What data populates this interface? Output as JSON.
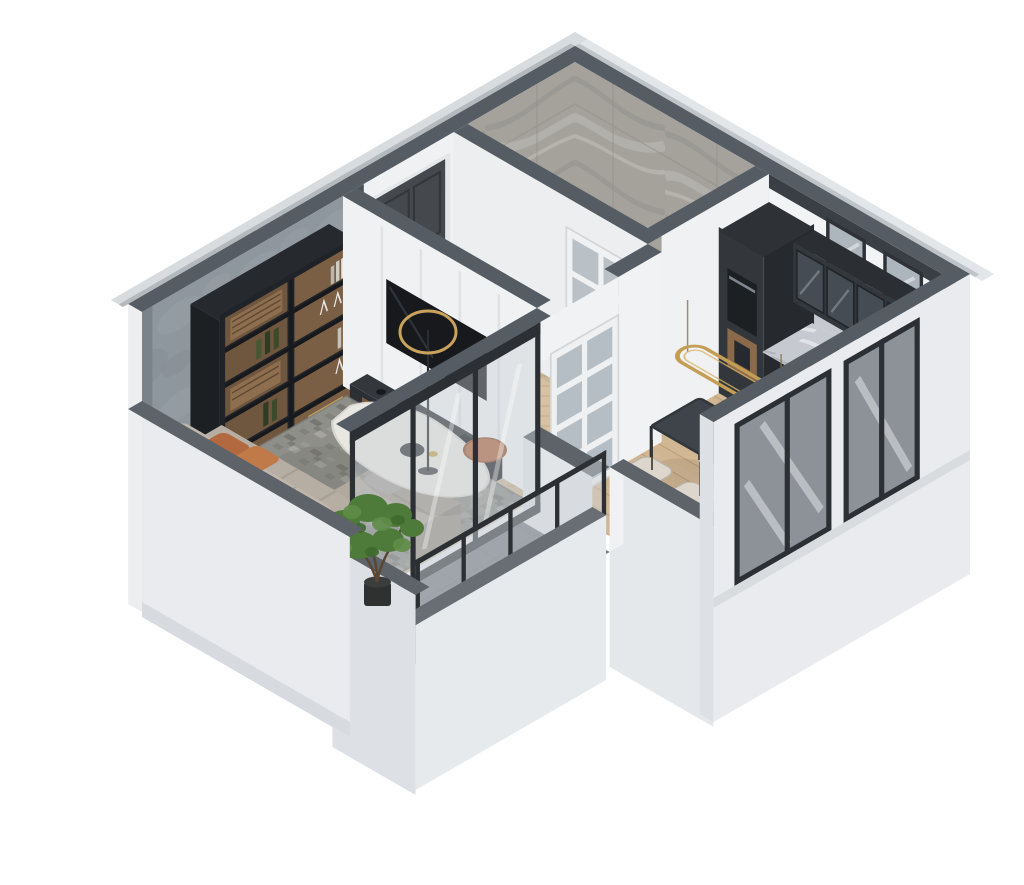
{
  "scene": {
    "title": "Isometric 3D cutaway floor plan render of a one-bedroom apartment",
    "background": "#ffffff",
    "style": "photoreal 3D render, top-down isometric cutaway, south walls lowered"
  },
  "colors": {
    "wall_top": "#565c63",
    "wall_top_low": "#5d6369",
    "ext_wall": "#e9ebee",
    "ext_wall_shade": "#d7dade",
    "int_wall": "#f2f3f4",
    "int_wall_shade": "#e6e8ea",
    "concrete": "#8f979e",
    "marble_wall": "#a5a29c",
    "charcoal": "#33373c",
    "charcoal_dark": "#26292d",
    "wood": "#7c5e41",
    "wood_light": "#8a6a4a",
    "herringbone_floor": "#d6c1a3",
    "plank_floor": "#d2b795",
    "bath_tile": "#d7cfc1",
    "rug": "#8f8f8a",
    "sofa": "#b7aea3",
    "sofa_back": "#c0b7ac",
    "cream_chair": "#dcd6cc",
    "rust": "#b2693f",
    "gold": "#c59e55",
    "glass": "#c9d0d6",
    "frame_dark": "#2c3035",
    "balcony_floor": "#71777c",
    "plant_green": "#4e7a3a",
    "table_top": "#3f444a",
    "door_dark": "#45494e",
    "tv_black": "#17191c"
  },
  "rooms": [
    {
      "name": "bathroom",
      "features": [
        "gray marble-clad corner walls",
        "white bathtub with faucet",
        "toilet",
        "wood vanity with basin"
      ]
    },
    {
      "name": "hallway",
      "features": [
        "dark graphite entry door",
        "herringbone parquet",
        "white glass-paned interior doors",
        "wainscot paneling"
      ]
    },
    {
      "name": "living-room",
      "features": [
        "concrete feature wall",
        "black shelving unit with bottles, glasses and books",
        "L-shaped greige sofa with rust pillows",
        "organic white marble coffee table",
        "rust round side table",
        "black ring floor lamp with brass ring",
        "mottled gray rug",
        "TV wall with charcoal media console"
      ]
    },
    {
      "name": "kitchen",
      "features": [
        "charcoal upper cabinets with glass fronts",
        "tall charcoal cabinet with oven and wood coffee niche",
        "marble countertop with sink and cooktop",
        "wood drawer fronts",
        "marble backsplash",
        "dark-framed clerestory windows"
      ]
    },
    {
      "name": "dining-area",
      "features": [
        "dark rectangular table",
        "six cream upholstered chairs",
        "brass oval ring pendant light",
        "plank wood floor"
      ]
    },
    {
      "name": "balcony",
      "features": [
        "concrete tile floor",
        "glass railing with dark posts",
        "white parapet walls",
        "green plant in dark pot"
      ]
    }
  ],
  "structure": {
    "exterior_walls": "white / light gray with dark slate wall tops",
    "cutaway": "south- and southwest-facing walls lowered for interior view",
    "windows": "dark-framed glazing on east facade and kitchen wall",
    "glazed_wall": "full-height dark-framed glass wall between living room and balcony"
  }
}
